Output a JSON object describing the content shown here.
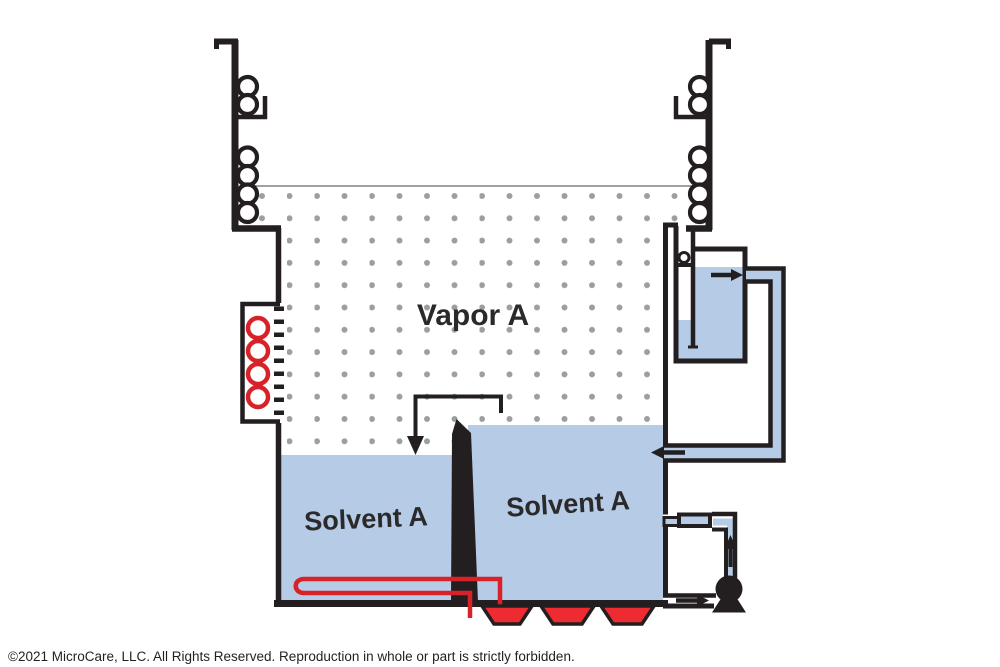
{
  "labels": {
    "vapor": "Vapor A",
    "solvent_left": "Solvent A",
    "solvent_right": "Solvent A"
  },
  "footer": {
    "copyright": "©2021 MicroCare, LLC. All Rights Reserved. Reproduction in whole or part is strictly forbidden."
  },
  "colors": {
    "liquid_blue": "#b6cbe6",
    "line_black": "#231f20",
    "heater_red": "#ee2b31",
    "coil_red": "#d7222a",
    "dot_gray": "#9b9ea3",
    "vapor_line_gray": "#808285"
  },
  "components": {
    "left_coils": "condensing-coils",
    "right_coils": "condensing-coils",
    "red_box": "refrigeration-coil-unit",
    "u_tube": "heat-exchanger-coil",
    "trapezoids": "sump-heaters",
    "separator": "water-separator",
    "pump": "pump",
    "filter": "filter",
    "divider": "weir"
  }
}
